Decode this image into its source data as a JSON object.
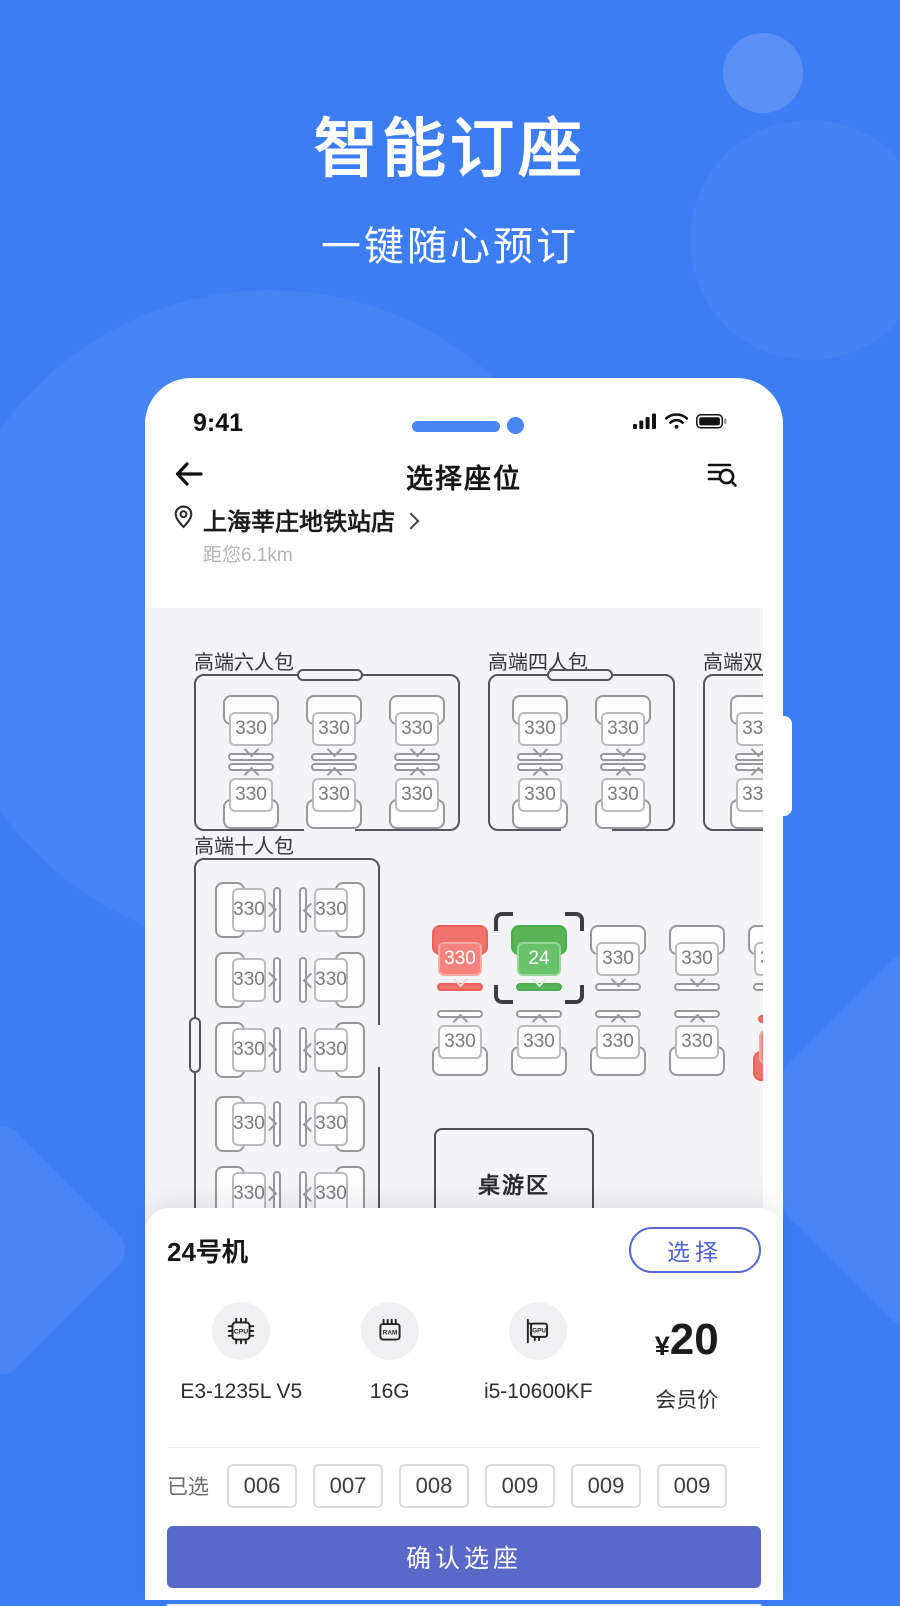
{
  "hero": {
    "title": "智能订座",
    "subtitle": "一键随心预订"
  },
  "statusbar": {
    "time": "9:41",
    "icons": [
      "signal-icon",
      "wifi-icon",
      "battery-icon"
    ]
  },
  "header": {
    "title": "选择座位"
  },
  "location": {
    "name": "上海莘庄地铁站店",
    "distance": "距您6.1km"
  },
  "map": {
    "background": "#F4F4F6",
    "rooms": [
      {
        "label": "高端六人包",
        "x": 49,
        "y": 66,
        "w": 266,
        "h": 157,
        "door": {
          "side": "top",
          "pos": 101,
          "len": 66
        },
        "gaps": [
          {
            "side": "bottom",
            "pos": 108,
            "len": 51
          }
        ]
      },
      {
        "label": "高端四人包",
        "x": 343,
        "y": 66,
        "w": 187,
        "h": 157,
        "door": {
          "side": "top",
          "pos": 57,
          "len": 66
        },
        "gaps": [
          {
            "side": "bottom",
            "pos": 71,
            "len": 51
          }
        ]
      },
      {
        "label": "高端双人包",
        "x": 558,
        "y": 66,
        "w": 170,
        "h": 157
      },
      {
        "label": "高端十人包",
        "x": 49,
        "y": 250,
        "w": 186,
        "h": 400,
        "door": {
          "side": "left",
          "pos": 157,
          "len": 56
        },
        "gaps": [
          {
            "side": "right",
            "pos": 165,
            "len": 42
          }
        ]
      }
    ],
    "board_game_area": {
      "label": "桌游区",
      "x": 289,
      "y": 520,
      "w": 160,
      "h": 100
    },
    "seats_format": [
      "x",
      "y",
      "direction",
      "state",
      "label"
    ],
    "seats": [
      [
        78,
        87,
        "down",
        "free",
        "330"
      ],
      [
        161,
        87,
        "down",
        "free",
        "330"
      ],
      [
        244,
        87,
        "down",
        "free",
        "330"
      ],
      [
        78,
        155,
        "up",
        "free",
        "330"
      ],
      [
        161,
        155,
        "up",
        "free",
        "330"
      ],
      [
        244,
        155,
        "up",
        "free",
        "330"
      ],
      [
        367,
        87,
        "down",
        "free",
        "330"
      ],
      [
        450,
        87,
        "down",
        "free",
        "330"
      ],
      [
        367,
        155,
        "up",
        "free",
        "330"
      ],
      [
        450,
        155,
        "up",
        "free",
        "330"
      ],
      [
        585,
        87,
        "down",
        "free",
        "330"
      ],
      [
        585,
        155,
        "up",
        "free",
        "330"
      ],
      [
        75,
        269,
        "rl",
        "free",
        "330"
      ],
      [
        159,
        269,
        "rr",
        "free",
        "330"
      ],
      [
        75,
        339,
        "rl",
        "free",
        "330"
      ],
      [
        159,
        339,
        "rr",
        "free",
        "330"
      ],
      [
        75,
        409,
        "rl",
        "free",
        "330"
      ],
      [
        159,
        409,
        "rr",
        "free",
        "330"
      ],
      [
        75,
        483,
        "rl",
        "free",
        "330"
      ],
      [
        159,
        483,
        "rr",
        "free",
        "330"
      ],
      [
        75,
        553,
        "rl",
        "free",
        "330"
      ],
      [
        159,
        553,
        "rr",
        "free",
        "330"
      ],
      [
        287,
        317,
        "down",
        "occupied",
        "330"
      ],
      [
        366,
        317,
        "down",
        "selected",
        "24"
      ],
      [
        445,
        317,
        "down",
        "free",
        "330"
      ],
      [
        524,
        317,
        "down",
        "free",
        "330"
      ],
      [
        603,
        317,
        "down",
        "free",
        "330"
      ],
      [
        287,
        402,
        "up",
        "free",
        "330"
      ],
      [
        366,
        402,
        "up",
        "free",
        "330"
      ],
      [
        445,
        402,
        "up",
        "free",
        "330"
      ],
      [
        524,
        402,
        "up",
        "free",
        "330"
      ],
      [
        608,
        407,
        "up",
        "occupied",
        "330"
      ]
    ]
  },
  "sheet": {
    "machine_title": "24号机",
    "select_button": "选择",
    "specs": [
      {
        "name": "cpu",
        "value": "E3-1235L V5"
      },
      {
        "name": "ram",
        "value": "16G"
      },
      {
        "name": "gpu",
        "value": "i5-10600KF"
      }
    ],
    "price": {
      "currency": "¥",
      "amount": "20",
      "label": "会员价"
    },
    "selected_label": "已选",
    "selected_seats": [
      "006",
      "007",
      "008",
      "009",
      "009",
      "009"
    ],
    "confirm_button": "确认选座"
  },
  "colors": {
    "background_blue": "#3C7DF4",
    "accent_blue": "#4787F4",
    "seat_occupied_red": "#F0736C",
    "seat_selected_green": "#57B557",
    "select_button_blue": "#5568D4",
    "confirm_button_indigo": "#5A68C8",
    "map_background": "#F4F4F6"
  }
}
